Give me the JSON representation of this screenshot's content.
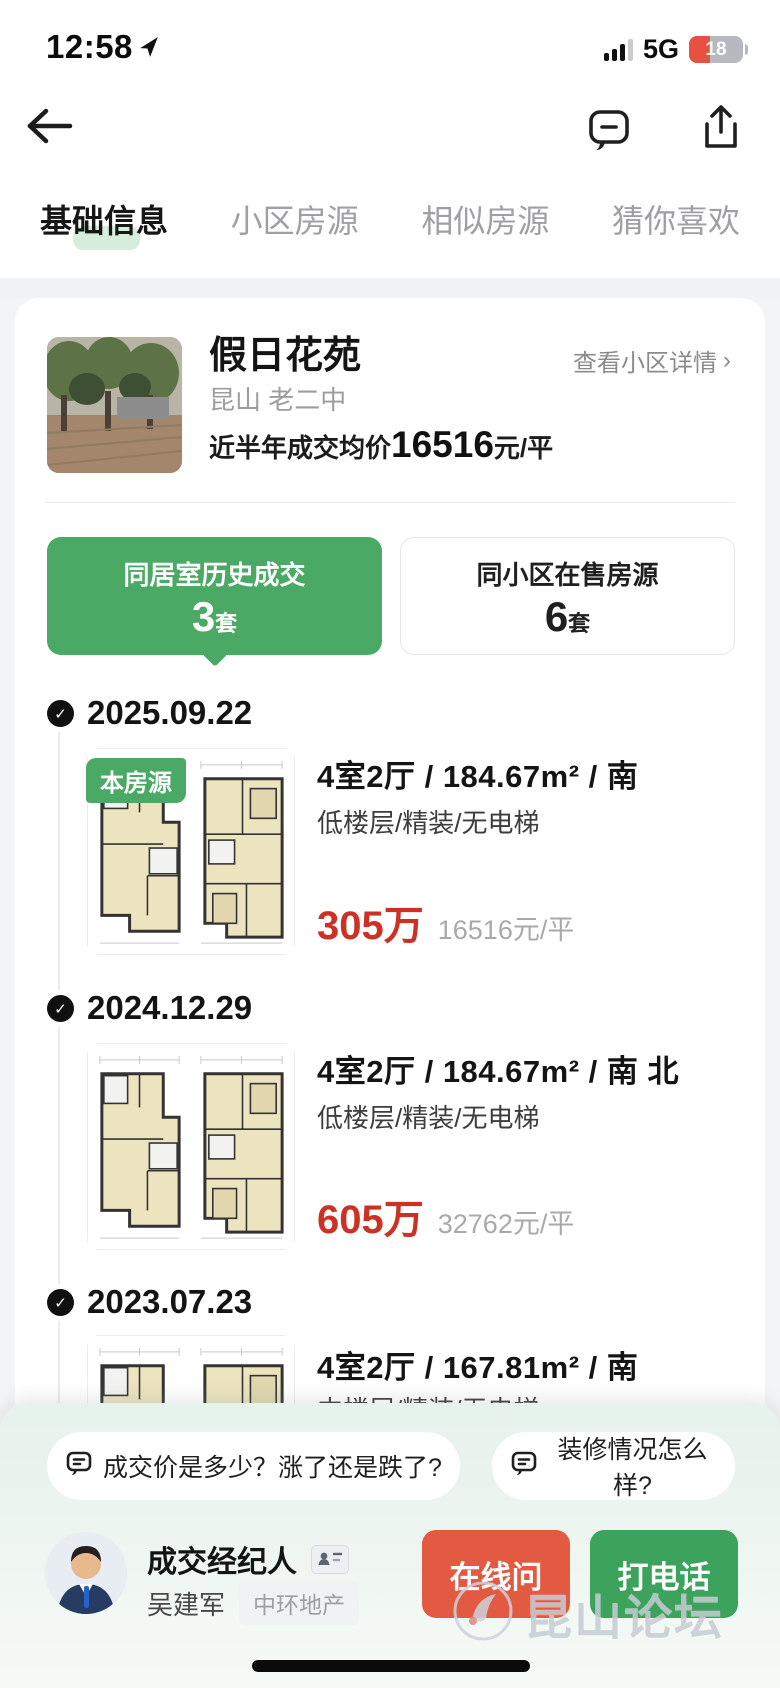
{
  "status_bar": {
    "time": "12:58",
    "network": "5G",
    "battery_level": "18"
  },
  "tabs": [
    {
      "label": "基础信息",
      "active": true
    },
    {
      "label": "小区房源",
      "active": false
    },
    {
      "label": "相似房源",
      "active": false
    },
    {
      "label": "猜你喜欢",
      "active": false
    }
  ],
  "community": {
    "name": "假日花苑",
    "detail_link": "查看小区详情",
    "detail_link_arrow": "›",
    "location": "昆山 老二中",
    "avg_price_label": "近半年成交均价",
    "avg_price_value": "16516",
    "avg_price_unit": "元/平"
  },
  "summary_cards": {
    "deals": {
      "title": "同居室历史成交",
      "count": "3",
      "unit": "套"
    },
    "on_sale": {
      "title": "同小区在售房源",
      "count": "6",
      "unit": "套"
    }
  },
  "timeline_check": "✓",
  "listings": [
    {
      "date": "2025.09.22",
      "badge": "本房源",
      "title": "4室2厅 / 184.67m² / 南",
      "tags": "低楼层/精装/无电梯",
      "price": "305万",
      "unit_price": "16516元/平"
    },
    {
      "date": "2024.12.29",
      "title": "4室2厅 / 184.67m² / 南 北",
      "tags": "低楼层/精装/无电梯",
      "price": "605万",
      "unit_price": "32762元/平"
    },
    {
      "date": "2023.07.23",
      "title": "4室2厅 / 167.81m² / 南",
      "tags": "中楼层/精装/无电梯"
    }
  ],
  "bottom_sheet": {
    "quick_questions": [
      "成交价是多少？涨了还是跌了?",
      "装修情况怎么样?"
    ],
    "agent": {
      "role": "成交经纪人",
      "name": "吴建军",
      "company": "中环地产"
    },
    "online_ask_button": "在线问",
    "call_button": "打电话"
  },
  "watermark": "昆山论坛",
  "colors": {
    "brand_green": "#3da25c",
    "active_card_green": "#4aa964",
    "price_red": "#cc3126",
    "ask_button_orange": "#e25a41",
    "tab_highlight_green": "#d6ecdd",
    "battery_warning_red": "#e8503f"
  }
}
